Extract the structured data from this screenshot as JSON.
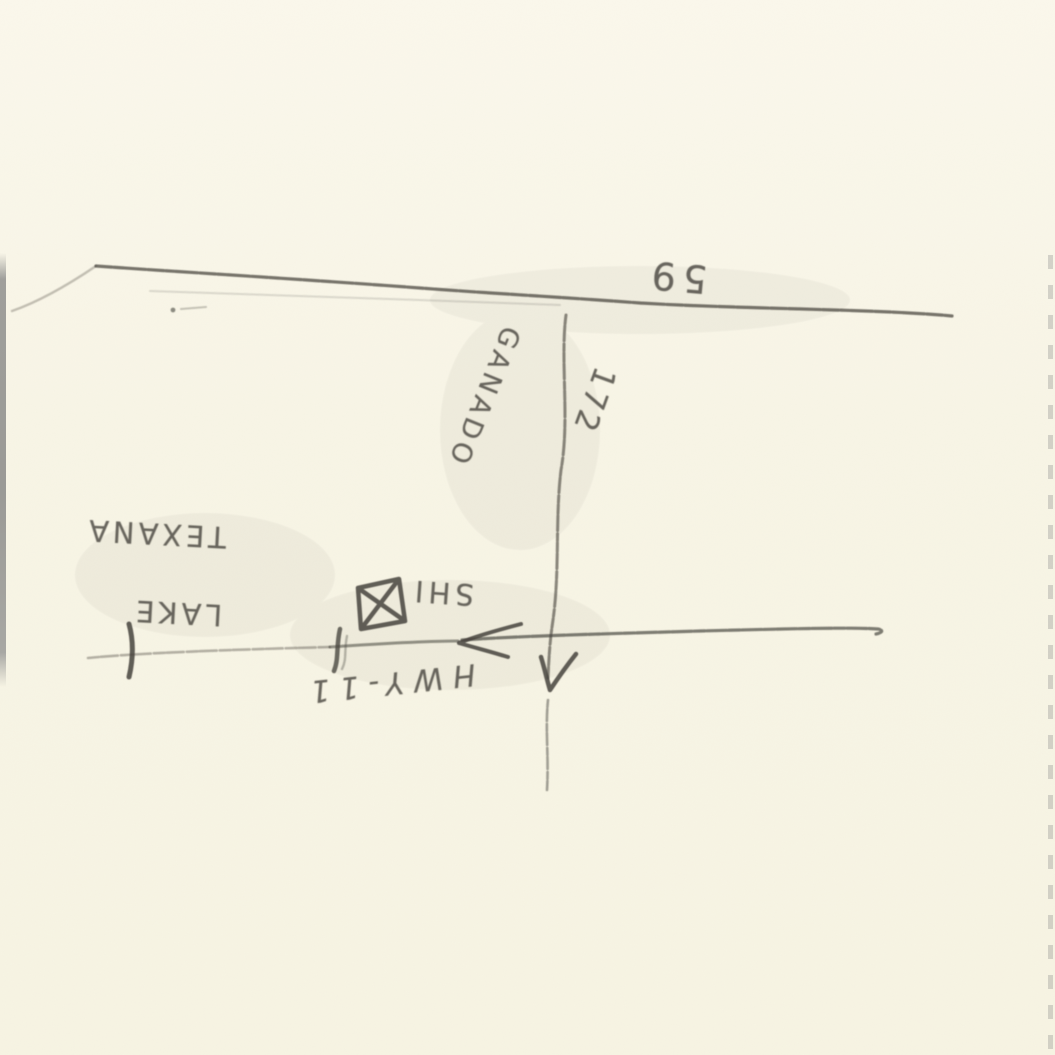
{
  "map": {
    "colors": {
      "paper": "#f8f5e6",
      "pencil": "#45423c",
      "edge_gray": "#90908e"
    },
    "labels": {
      "highway_59": {
        "text": "59"
      },
      "town_ganado": {
        "text": "GANADO"
      },
      "road_172": {
        "text": "172"
      },
      "lake_texana": {
        "line1": "LAKE",
        "line2": "TEXANA"
      },
      "building": {
        "text": "SHI"
      },
      "highway_11": {
        "text": "HWY-11"
      }
    },
    "icons": {
      "building_marker": "box-with-x-building-icon",
      "road_arrow": "left-arrowhead-icon",
      "vertical_road_arrow": "down-arrowhead-icon"
    }
  }
}
